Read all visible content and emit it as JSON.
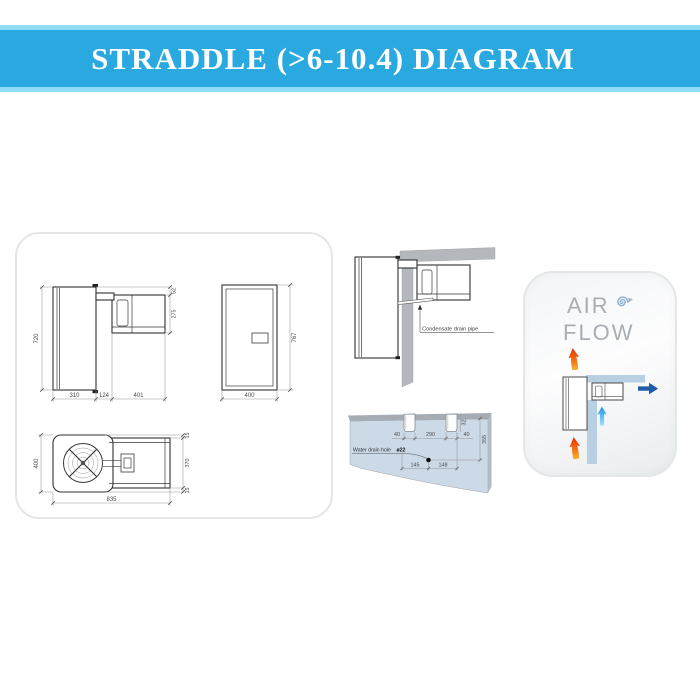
{
  "header": {
    "title": "STRADDLE (>6-10.4) DIAGRAM"
  },
  "views": {
    "side": {
      "height": "720",
      "top_offset": "52",
      "unit_height": "275",
      "body_depth": "310",
      "wall_gap": "124",
      "outdoor_depth": "401"
    },
    "front": {
      "height": "767",
      "width": "400"
    },
    "top": {
      "width": "400",
      "edge_top": "15",
      "depth": "370",
      "edge_bottom": "15",
      "length": "835"
    }
  },
  "condensate": {
    "label": "Condensate drain pipe"
  },
  "drain": {
    "label": "Water drain hole",
    "hole_diameter": "ø22",
    "slot_left_width": "40",
    "slot_spacing": "290",
    "slot_right_width": "40",
    "slot_depth": "32",
    "hole_height": "355",
    "hole_offset_left": "145",
    "hole_offset_right": "148"
  },
  "airflow": {
    "word1": "AIR",
    "word2": "FLOW"
  },
  "colors": {
    "banner": "#29a9e0",
    "banner_edge": "#90dbf5",
    "title_text": "#ffffff",
    "wall_gray": "#b4b8bc",
    "wall_panel_blue": "#ccd9e7",
    "airflow_wall_blue": "#b9cfe2",
    "hot_air_arrow_tip": "#e63109",
    "hot_air_arrow_tail": "#f9b032",
    "cold_air_arrow": "#1d97dd",
    "supply_air_arrow": "#1f5ea7",
    "drawing_line": "#303030",
    "dimension_line": "#989898"
  }
}
